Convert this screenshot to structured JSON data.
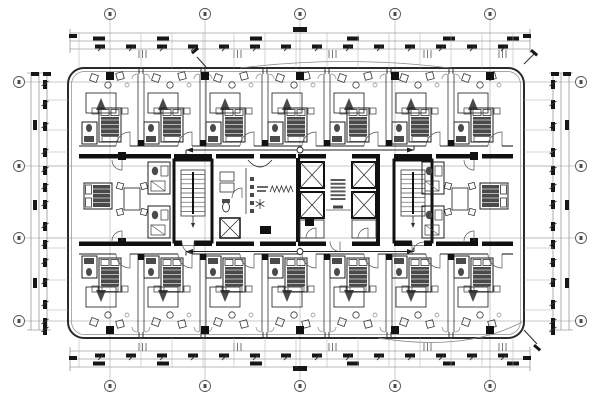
{
  "meta": {
    "description": "architectural floor plan drawing, hotel guest floor, black CAD linework on white",
    "colors": {
      "heavy": "#111111",
      "dark": "#1c1c1c",
      "med": "#333333",
      "thin": "#555555",
      "faint": "#8a8a8a",
      "grid": "#b9b9b9",
      "blob": "#161616",
      "fill_dark": "#4a4a4a",
      "bg": "#ffffff"
    }
  },
  "canvas": {
    "w": 600,
    "h": 400
  },
  "building": {
    "x": 68,
    "y": 68,
    "w": 456,
    "h": 270,
    "r": 16,
    "inner_inset": 3.5
  },
  "grid": {
    "cols": [
      110,
      205,
      300,
      395,
      490
    ],
    "rows": [
      82,
      166,
      238,
      321
    ],
    "col_bubble_y": {
      "top": 14,
      "bottom": 386
    },
    "row_bubble_x": {
      "left": 19,
      "right": 581
    },
    "bubble_r": 5.5
  },
  "rooms": {
    "top_centers": [
      110,
      172,
      234,
      296,
      358,
      420,
      482
    ],
    "bottom_centers": [
      110,
      172,
      234,
      296,
      358,
      420,
      482
    ],
    "boundaries": [
      141,
      203,
      265,
      327,
      389,
      451
    ],
    "left_edge": 79,
    "right_edge": 513,
    "top_band": {
      "window_y": 68,
      "inner_y": 74,
      "corridor_wall_y": 146
    },
    "bottom_band": {
      "window_y": 338,
      "inner_y": 332,
      "corridor_wall_y": 254
    }
  },
  "core": {
    "y1": 154,
    "y2": 241.5,
    "wall_h": 4.5,
    "top_wall_segments": [
      [
        79,
        118
      ],
      [
        126,
        171
      ],
      [
        174,
        212
      ],
      [
        216,
        254
      ],
      [
        260,
        296
      ],
      [
        298,
        326
      ],
      [
        352,
        380
      ],
      [
        394,
        432
      ],
      [
        436,
        474
      ],
      [
        482,
        513
      ]
    ],
    "bottom_wall_segments": [
      [
        79,
        118
      ],
      [
        126,
        171
      ],
      [
        174,
        212
      ],
      [
        216,
        254
      ],
      [
        260,
        296
      ],
      [
        298,
        326
      ],
      [
        352,
        380
      ],
      [
        394,
        432
      ],
      [
        436,
        474
      ],
      [
        482,
        513
      ]
    ],
    "stairs": [
      {
        "x": 174,
        "door_pivot_right": true
      },
      {
        "x": 394,
        "door_pivot_right": false
      }
    ],
    "stair_size": {
      "w": 38,
      "h": 82,
      "flight": {
        "dx": 7,
        "dy": 10,
        "w": 24,
        "h": 46,
        "treads": 9
      }
    },
    "elevator_banks": [
      {
        "x": 300
      },
      {
        "x": 352
      }
    ],
    "elevator_shaft": {
      "w": 24,
      "h": 26,
      "gap": 4,
      "y": 162
    },
    "heavy_vwalls": [
      [
        296,
        158,
        4,
        84
      ],
      [
        376,
        158,
        4,
        84
      ]
    ],
    "lobby_note": {
      "x": 330.5,
      "y": 179,
      "lines": 6,
      "line_w": 15,
      "line_gap": 3.8
    },
    "lobby_small_label": [
      333,
      205.5,
      10,
      3
    ],
    "dark_boxes": [
      [
        305,
        218,
        9,
        8
      ],
      [
        260,
        226,
        11,
        8
      ]
    ],
    "suite_door_columns": [
      [
        118,
        152
      ],
      [
        118,
        238
      ],
      [
        470,
        152
      ],
      [
        470,
        238
      ]
    ]
  },
  "suites": {
    "left": {
      "x1": 79,
      "x2": 171
    },
    "right": {
      "x1": 424,
      "x2": 513
    }
  },
  "service_room": {
    "x1": 216,
    "x2": 296,
    "closets": [
      [
        220,
        172,
        14,
        9
      ],
      [
        220,
        183,
        14,
        9
      ]
    ],
    "column_dash_x": 252,
    "column_dash_y0": 177,
    "column_dash_n": 5,
    "star_center": [
      260,
      204
    ],
    "zigzag": {
      "x1": 270,
      "x2": 293,
      "y": 192,
      "amp": 6,
      "n": 5
    },
    "dumbwaiter": [
      220,
      218,
      20,
      20
    ],
    "gray_labels": [
      [
        257,
        186,
        11,
        2
      ],
      [
        257,
        190,
        9,
        2
      ]
    ]
  },
  "corridor_arrows": [
    {
      "x1": 186,
      "x2": 414,
      "y": 150,
      "circle_x": 300
    },
    {
      "x1": 186,
      "x2": 414,
      "y": 251.5,
      "circle_x": 300
    }
  ],
  "window_columns": {
    "size": 8,
    "top_y": 72,
    "bottom_y": 326
  },
  "dims": {
    "top": {
      "lines_y": [
        33,
        41,
        49
      ],
      "x1": 70,
      "x2": 530,
      "rowA": {
        "y": 36.5,
        "blob_x": [
          93,
          157,
          250,
          347,
          443,
          507
        ]
      },
      "rowB": {
        "y": 44.5,
        "blob_x": [
          95,
          126,
          157,
          188,
          219,
          250,
          281,
          312,
          343,
          374,
          405,
          436,
          467,
          498
        ]
      },
      "overall_blob": [
        293,
        27
      ],
      "corner_blobs": [
        [
          69,
          34
        ],
        [
          523,
          34
        ]
      ],
      "triticks": {
        "y": 50,
        "xs": [
          139,
          234,
          329,
          424,
          499
        ]
      },
      "witness_x": [
        79,
        141,
        172,
        203,
        234,
        265,
        296,
        327,
        358,
        389,
        420,
        451,
        482,
        513
      ]
    },
    "bottom": {
      "lines_y": [
        351,
        359,
        367
      ],
      "x1": 70,
      "x2": 530,
      "rowA": {
        "y": 361.5,
        "blob_x": [
          93,
          157,
          250,
          347,
          443,
          507
        ]
      },
      "rowB": {
        "y": 353.5,
        "blob_x": [
          95,
          126,
          157,
          188,
          219,
          250,
          281,
          312,
          343,
          374,
          405,
          436,
          467,
          498
        ]
      },
      "overall_blob": [
        293,
        366
      ],
      "corner_blobs": [
        [
          69,
          356
        ],
        [
          523,
          356
        ]
      ],
      "triticks": {
        "y": 343,
        "xs": [
          139,
          234,
          329,
          424,
          499
        ]
      },
      "witness_x": [
        79,
        141,
        172,
        203,
        234,
        265,
        296,
        327,
        358,
        389,
        420,
        451,
        482,
        513
      ]
    },
    "left": {
      "lines_x": [
        31,
        39,
        47
      ],
      "y1": 73,
      "y2": 330,
      "colA": {
        "x": 33,
        "blob_y": [
          120,
          200,
          278
        ]
      },
      "colB": {
        "x": 43,
        "blob_y": [
          80,
          100,
          122,
          148,
          166,
          183,
          200,
          222,
          240,
          258,
          278,
          300,
          318,
          326
        ]
      },
      "pairs": [
        [
          31,
          72
        ],
        [
          43,
          72
        ]
      ],
      "witness_y": [
        100,
        130,
        152,
        166,
        238,
        248,
        280,
        310
      ]
    },
    "right": {
      "lines_x": [
        553,
        561,
        569
      ],
      "y1": 73,
      "y2": 330,
      "colA": {
        "x": 565,
        "blob_y": [
          120,
          200,
          278
        ]
      },
      "colB": {
        "x": 551,
        "blob_y": [
          80,
          100,
          122,
          148,
          166,
          183,
          200,
          222,
          240,
          258,
          278,
          300,
          318,
          326
        ]
      },
      "pairs": [
        [
          551,
          72
        ],
        [
          563,
          72
        ]
      ],
      "witness_y": [
        100,
        130,
        152,
        166,
        238,
        248,
        280,
        310
      ]
    }
  },
  "callouts": [
    {
      "line": [
        206,
        67,
        197,
        57
      ],
      "blob": [
        191,
        52,
        8,
        3
      ],
      "rot": -40
    },
    {
      "line": [
        524,
        64,
        534,
        54
      ],
      "blob": [
        532,
        49,
        8,
        3
      ],
      "rot": 40
    },
    {
      "line": [
        524,
        330,
        537,
        344
      ],
      "blob": [
        535,
        344,
        8,
        3
      ],
      "rot": 40
    }
  ],
  "facade_arcs": {
    "top_canopy": "M 240,68 Q 345,55 450,68",
    "bottom_curve": "M 378,338 Q 466,352 522,322"
  }
}
